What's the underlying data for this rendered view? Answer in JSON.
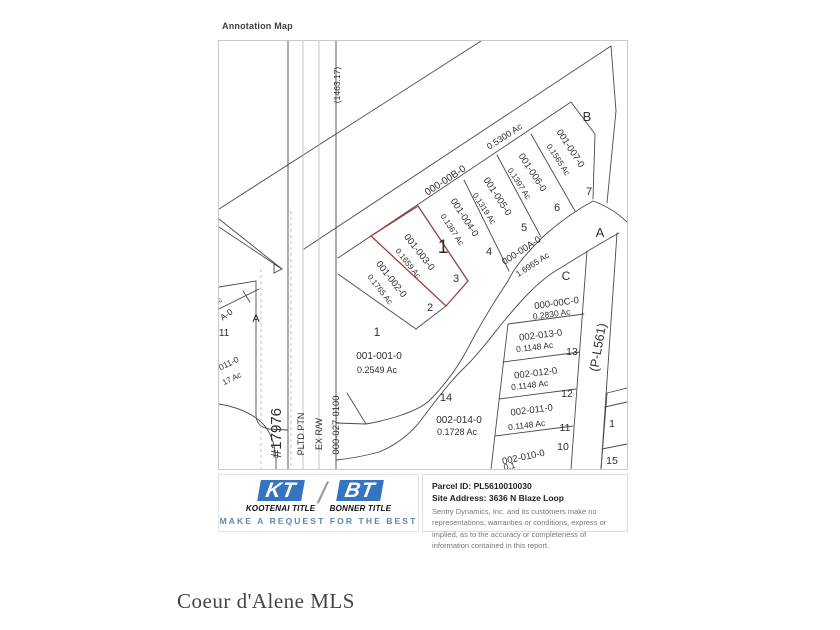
{
  "page": {
    "annotation_label": "Annotation Map",
    "watermark": "Coeur d'Alene MLS"
  },
  "map": {
    "colors": {
      "text": "#2f2f2f",
      "line_dark": "#4a4a4a",
      "line_light": "#b5b5b5",
      "highlight_red": "#9d3c38"
    },
    "labels": [
      {
        "id": "dim-1463-17",
        "text": "(1463.17)",
        "x": 121,
        "y": 44,
        "rot": -90,
        "size": 8.5
      },
      {
        "id": "survey-17976",
        "text": "#17976",
        "x": 62,
        "y": 392,
        "rot": -90,
        "size": 15
      },
      {
        "id": "pltd-ptn",
        "text": "PLTD PTN",
        "x": 85,
        "y": 393,
        "rot": -90,
        "size": 9
      },
      {
        "id": "ex-rw",
        "text": "EX R/W",
        "x": 103,
        "y": 393,
        "rot": -90,
        "size": 9
      },
      {
        "id": "parcel-000-027-0100",
        "text": "000-027-0100",
        "x": 120,
        "y": 384,
        "rot": -90,
        "size": 9.5
      },
      {
        "id": "parcel-000-00b-0",
        "text": "000-00B-0",
        "x": 228,
        "y": 142,
        "rot": -33,
        "size": 10
      },
      {
        "id": "acreage-000-00b-0",
        "text": "0.5300 Ac",
        "x": 287,
        "y": 98,
        "rot": -33,
        "size": 9
      },
      {
        "id": "block-b",
        "text": "B",
        "x": 368,
        "y": 80,
        "rot": 0,
        "size": 13
      },
      {
        "id": "block-a",
        "text": "A",
        "x": 381,
        "y": 196,
        "rot": 0,
        "size": 13
      },
      {
        "id": "block-c",
        "text": "C",
        "x": 347,
        "y": 239,
        "rot": 0,
        "size": 12
      },
      {
        "id": "parcel-001-007-0",
        "text": "001-007-0",
        "x": 349,
        "y": 109,
        "rot": 57,
        "size": 9.5
      },
      {
        "id": "acreage-001-007-0",
        "text": "0.1565 Ac",
        "x": 337,
        "y": 120,
        "rot": 57,
        "size": 8
      },
      {
        "id": "lot-7",
        "text": "7",
        "x": 370,
        "y": 154,
        "rot": 0,
        "size": 11
      },
      {
        "id": "parcel-001-006-0",
        "text": "001-006-0",
        "x": 311,
        "y": 133,
        "rot": 57,
        "size": 9.5
      },
      {
        "id": "acreage-001-006-0",
        "text": "0.1397 Ac",
        "x": 298,
        "y": 144,
        "rot": 57,
        "size": 8
      },
      {
        "id": "lot-6",
        "text": "6",
        "x": 338,
        "y": 170,
        "rot": 0,
        "size": 11
      },
      {
        "id": "parcel-001-005-0",
        "text": "001-005-0",
        "x": 276,
        "y": 157,
        "rot": 57,
        "size": 9.5
      },
      {
        "id": "acreage-001-005-0",
        "text": "0.1319 Ac",
        "x": 263,
        "y": 169,
        "rot": 57,
        "size": 8
      },
      {
        "id": "lot-5",
        "text": "5",
        "x": 305,
        "y": 190,
        "rot": 0,
        "size": 11
      },
      {
        "id": "parcel-001-004-0",
        "text": "001-004-0",
        "x": 243,
        "y": 178,
        "rot": 57,
        "size": 9.5
      },
      {
        "id": "acreage-001-004-0",
        "text": "0.1367 Ac",
        "x": 231,
        "y": 190,
        "rot": 57,
        "size": 8
      },
      {
        "id": "lot-4",
        "text": "4",
        "x": 270,
        "y": 214,
        "rot": 0,
        "size": 11
      },
      {
        "id": "annotation-marker-1",
        "text": "1",
        "x": 224,
        "y": 212,
        "rot": 0,
        "size": 19,
        "serif": true
      },
      {
        "id": "parcel-001-003-0",
        "text": "001-003-0",
        "x": 198,
        "y": 213,
        "rot": 52,
        "size": 9.5
      },
      {
        "id": "acreage-001-003-0",
        "text": "0.1659 Ac",
        "x": 187,
        "y": 224,
        "rot": 52,
        "size": 8
      },
      {
        "id": "lot-3",
        "text": "3",
        "x": 237,
        "y": 241,
        "rot": 0,
        "size": 11
      },
      {
        "id": "parcel-001-002-0",
        "text": "001-002-0",
        "x": 170,
        "y": 240,
        "rot": 52,
        "size": 9.5
      },
      {
        "id": "acreage-001-002-0",
        "text": "0.1765 Ac",
        "x": 159,
        "y": 250,
        "rot": 52,
        "size": 8
      },
      {
        "id": "lot-2",
        "text": "2",
        "x": 211,
        "y": 270,
        "rot": 0,
        "size": 11
      },
      {
        "id": "parcel-000-00a-0",
        "text": "000-00A-0",
        "x": 304,
        "y": 212,
        "rot": -33,
        "size": 9.5
      },
      {
        "id": "acreage-000-00a-0",
        "text": "1.6965 Ac",
        "x": 315,
        "y": 226,
        "rot": -33,
        "size": 8.5
      },
      {
        "id": "lot-1",
        "text": "1",
        "x": 158,
        "y": 295,
        "rot": 0,
        "size": 12
      },
      {
        "id": "parcel-001-001-0",
        "text": "001-001-0",
        "x": 160,
        "y": 318,
        "rot": 0,
        "size": 10
      },
      {
        "id": "acreage-001-001-0",
        "text": "0.2549 Ac",
        "x": 158,
        "y": 332,
        "rot": 0,
        "size": 9
      },
      {
        "id": "parcel-000-00c-0",
        "text": "000-00C-0",
        "x": 338,
        "y": 265,
        "rot": -8,
        "size": 9.5
      },
      {
        "id": "acreage-000-00c-0",
        "text": "0.2830 Ac",
        "x": 333,
        "y": 276,
        "rot": -8,
        "size": 8.5
      },
      {
        "id": "parcel-002-013-0",
        "text": "002-013-0",
        "x": 322,
        "y": 297,
        "rot": -7,
        "size": 9.5
      },
      {
        "id": "acreage-002-013-0",
        "text": "0.1148 Ac",
        "x": 316,
        "y": 309,
        "rot": -7,
        "size": 8.5
      },
      {
        "id": "lot-13",
        "text": "13",
        "x": 353,
        "y": 314,
        "rot": 0,
        "size": 10.5
      },
      {
        "id": "parcel-002-012-0",
        "text": "002-012-0",
        "x": 317,
        "y": 335,
        "rot": -7,
        "size": 9.5
      },
      {
        "id": "acreage-002-012-0",
        "text": "0.1148 Ac",
        "x": 311,
        "y": 347,
        "rot": -7,
        "size": 8.5
      },
      {
        "id": "lot-12",
        "text": "12",
        "x": 348,
        "y": 356,
        "rot": 0,
        "size": 10.5
      },
      {
        "id": "parcel-002-011-0",
        "text": "002-011-0",
        "x": 313,
        "y": 372,
        "rot": -7,
        "size": 9.5
      },
      {
        "id": "acreage-002-011-0",
        "text": "0.1148 Ac",
        "x": 308,
        "y": 387,
        "rot": -7,
        "size": 8.5
      },
      {
        "id": "lot-11",
        "text": "11",
        "x": 346,
        "y": 390,
        "rot": 0,
        "size": 10.5
      },
      {
        "id": "lot-10",
        "text": "10",
        "x": 344,
        "y": 409,
        "rot": 0,
        "size": 10.5
      },
      {
        "id": "parcel-002-010-0",
        "text": "002-010-0",
        "x": 305,
        "y": 419,
        "rot": -12,
        "size": 9.5
      },
      {
        "id": "acreage-002-010-0",
        "text": "0.1",
        "x": 291,
        "y": 428,
        "rot": -12,
        "size": 8.5
      },
      {
        "id": "lot-14",
        "text": "14",
        "x": 227,
        "y": 360,
        "rot": 0,
        "size": 11
      },
      {
        "id": "parcel-002-014-0",
        "text": "002-014-0",
        "x": 240,
        "y": 382,
        "rot": 0,
        "size": 10
      },
      {
        "id": "acreage-002-014-0",
        "text": "0.1728 Ac",
        "x": 238,
        "y": 394,
        "rot": 0,
        "size": 9
      },
      {
        "id": "road-p-l561",
        "text": "(P-L561)",
        "x": 383,
        "y": 307,
        "rot": -80,
        "size": 12.5
      },
      {
        "id": "lot-16-partial",
        "text": "1",
        "x": 393,
        "y": 386,
        "rot": 0,
        "size": 10.5
      },
      {
        "id": "lot-15",
        "text": "15",
        "x": 393,
        "y": 423,
        "rot": 0,
        "size": 10.5
      },
      {
        "id": "block-a-left",
        "text": "A",
        "x": 37,
        "y": 281,
        "rot": 0,
        "size": 11
      },
      {
        "id": "lot-11-left",
        "text": "11",
        "x": 5,
        "y": 295,
        "rot": 0,
        "size": 10
      },
      {
        "id": "partial-ac-left",
        "text": "c",
        "x": 2,
        "y": 261,
        "rot": -35,
        "size": 7
      },
      {
        "id": "partial-parcel-a-0",
        "text": "A-0",
        "x": 9,
        "y": 276,
        "rot": -35,
        "size": 8.5
      },
      {
        "id": "partial-parcel-011-0",
        "text": "011-0",
        "x": 11,
        "y": 325,
        "rot": -26,
        "size": 8.5
      },
      {
        "id": "partial-acreage-17",
        "text": "17 Ac",
        "x": 14,
        "y": 340,
        "rot": -26,
        "size": 8
      }
    ]
  },
  "footer": {
    "logo": {
      "kt": "KT",
      "bt": "BT",
      "slash": "/",
      "kootenai": "KOOTENAI TITLE",
      "bonner": "BONNER TITLE",
      "tagline": "MAKE A REQUEST FOR THE BEST",
      "logo_blue": "#3474c0",
      "tagline_blue": "#5d87b0"
    },
    "info": {
      "parcel_id": "Parcel ID: PL5610010030",
      "site_address": "Site Address: 3636 N Blaze Loop",
      "disclaimer": "Sentry Dynamics, Inc. and its customers make no representations, warranties or conditions, express or implied, as to the accuracy or completeness of information contained in this report."
    }
  }
}
